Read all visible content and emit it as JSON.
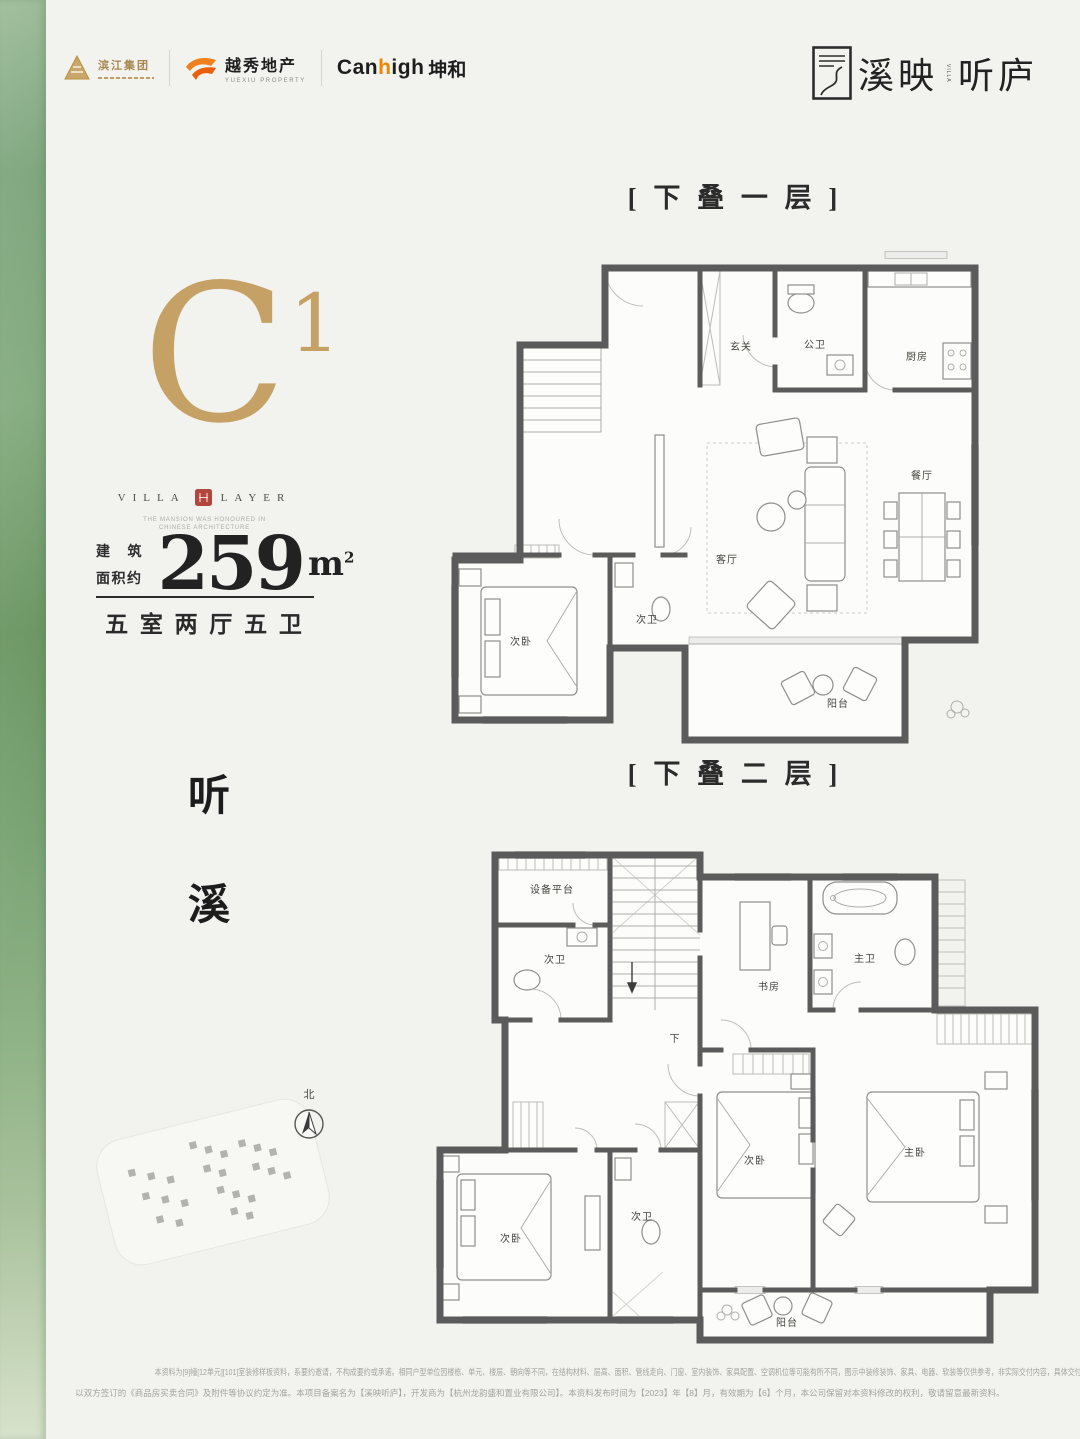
{
  "colors": {
    "gold": "#c5a166",
    "seal_red": "#b2473d",
    "brand_orange": "#f08300",
    "wall_gray": "#5b5b5b",
    "green_strip": "#7aa374"
  },
  "header": {
    "binjiang_name": "滨江集团",
    "yuexiu_name": "越秀地产",
    "yuexiu_sub": "YUEXIU PROPERTY",
    "canhigh_pre": "Can",
    "canhigh_accent": "h",
    "canhigh_post": "igh",
    "canhigh_cn": "坤和",
    "brand_left": "溪映",
    "brand_right": "听庐",
    "brand_mini": "VILLA"
  },
  "unit": {
    "code": "C",
    "code_sup": "1",
    "villa": "VILLA",
    "layer": "LAYER",
    "tagline1": "THE MANSION WAS HONOURED IN",
    "tagline2": "CHINESE ARCHITECTURE",
    "area_label1": "建 筑",
    "area_label2": "面积约",
    "area_value": "259",
    "area_unit": "m",
    "area_unit_sup": "2",
    "layout": "五 室 两 厅 五 卫",
    "poetic1": "听",
    "poetic2": "溪"
  },
  "compass_north": "北",
  "plan1": {
    "title": "[ 下 叠 一 层 ]",
    "rooms": {
      "entry": "玄关",
      "pub_bath": "公卫",
      "kitchen": "厨房",
      "dining": "餐厅",
      "living": "客厅",
      "bedroom": "次卧",
      "bath": "次卫",
      "balcony": "阳台"
    }
  },
  "plan2": {
    "title": "[ 下 叠 二 层 ]",
    "stair_down": "下",
    "rooms": {
      "equip": "设备平台",
      "bath_top": "次卫",
      "study": "书房",
      "master_bath": "主卫",
      "bedroom_left": "次卧",
      "bath_mid": "次卫",
      "bedroom_mid": "次卧",
      "master": "主卧",
      "balcony": "阳台"
    }
  },
  "footer": {
    "line1": "本资料为[9]幢[12单元][101]室装修样板资料，系要约邀请，不构成要约或承诺。相同户型单位因楼栋、单元、楼层、朝向等不同，在结构材料、层高、面积、管线走向、门窗、室内装饰、家具配置、空调机位等可能有所不同，图示中装修装饰、家具、电器、软装等仅供参考，非实际交付内容，具体交付标准",
    "line2": "以双方签订的《商品房买卖合同》及附件等协议约定为准。本项目备案名为【溪映听庐】，开发商为【杭州龙韵盛和置业有限公司】。本资料发布时间为【2023】年【8】月，有效期为【6】个月，本公司保留对本资料修改的权利，敬请留意最新资料。"
  }
}
